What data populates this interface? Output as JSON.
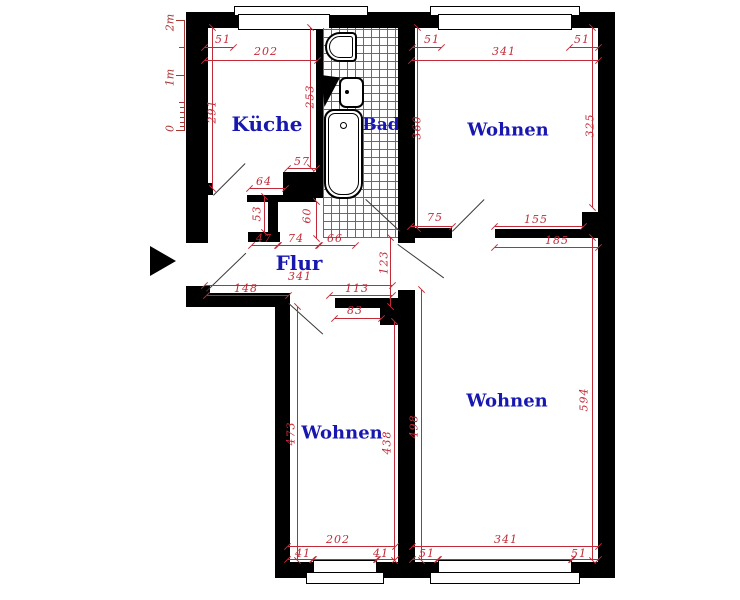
{
  "plan_title": "Wohnung Grundriss",
  "rooms": [
    {
      "id": "kueche",
      "label": "Küche"
    },
    {
      "id": "bad",
      "label": "Bad"
    },
    {
      "id": "wohnen_top",
      "label": "Wohnen"
    },
    {
      "id": "flur",
      "label": "Flur"
    },
    {
      "id": "wohnen_bottom_left",
      "label": "Wohnen"
    },
    {
      "id": "wohnen_bottom_right",
      "label": "Wohnen"
    }
  ],
  "ruler": {
    "top": "2m",
    "mid": "1m",
    "zero": "0"
  },
  "dims": {
    "kueche_win_offset": "51",
    "kueche_width": "202",
    "kueche_h_left": "291",
    "kueche_h_right": "253",
    "pass57": "57",
    "pass64": "64",
    "niche53": "53",
    "niche60": "60",
    "flur47": "47",
    "flur74": "74",
    "flur66": "66",
    "wt_off_l": "51",
    "wt_width": "341",
    "wt_off_r": "51",
    "wt_h_l": "360",
    "wt_h_r": "325",
    "door75": "75",
    "wall155": "155",
    "wall185": "185",
    "flur_width": "341",
    "flur148": "148",
    "flur113": "113",
    "door83": "83",
    "corr123": "123",
    "wbl_h_l": "473",
    "wbl_h_r": "438",
    "wbl_width": "202",
    "wbl_off_l": "41",
    "wbl_off_r": "41",
    "wbr_h_l": "498",
    "wbr_h_r": "594",
    "wbr_width": "341",
    "wbr_off_l": "51",
    "wbr_off_r": "51"
  },
  "colors": {
    "dimension": "#c12b38",
    "room_label": "#1818b0",
    "wall": "#000000"
  }
}
